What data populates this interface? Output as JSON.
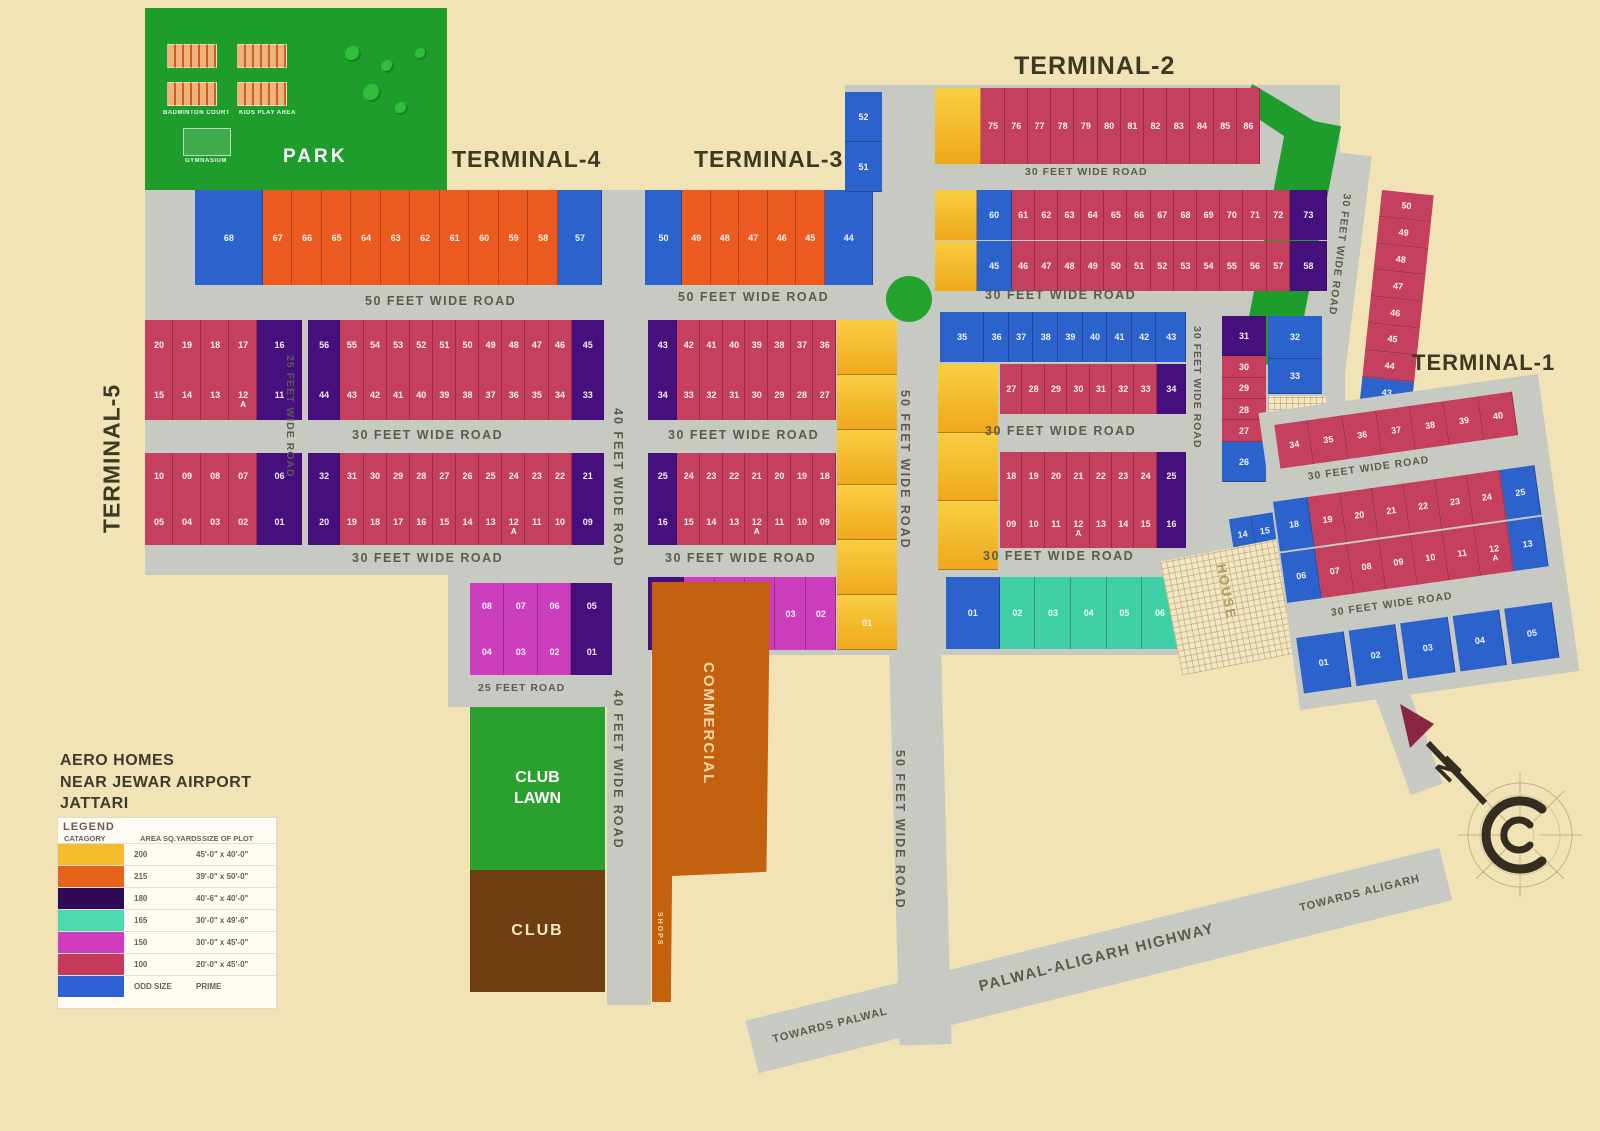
{
  "title": {
    "line1": "AERO HOMES",
    "line2": "NEAR JEWAR AIRPORT",
    "line3": "JATTARI"
  },
  "terminals": {
    "t1": "TERMINAL-1",
    "t2": "TERMINAL-2",
    "t3": "TERMINAL-3",
    "t4": "TERMINAL-4",
    "t5": "TERMINAL-5"
  },
  "park": {
    "label": "PARK",
    "badminton": "BADMINTON COURT",
    "kids": "KIDS PLAY AREA",
    "gym": "GYMNASIUM"
  },
  "amenities": {
    "club_lawn": "CLUB LAWN",
    "club": "CLUB",
    "commercial": "COMMERCIAL",
    "shops": "SHOPS",
    "house": "HOUSE"
  },
  "compass": {
    "n": "N"
  },
  "highway": {
    "name": "PALWAL-ALIGARH HIGHWAY",
    "towards_left": "TOWARDS PALWAL",
    "towards_right": "TOWARDS ALIGARH"
  },
  "roads": {
    "r50a": "50 FEET WIDE ROAD",
    "r50b": "50 FEET WIDE ROAD",
    "r30top": "30 FEET WIDE ROAD",
    "r30t2": "30 FEET WIDE ROAD",
    "r30l1": "30 FEET WIDE ROAD",
    "r30c1": "30 FEET WIDE ROAD",
    "r30r1": "30 FEET WIDE ROAD",
    "r30l2": "30 FEET WIDE ROAD",
    "r30c2": "30 FEET WIDE ROAD",
    "r30r2": "30 FEET WIDE ROAD",
    "r25v": "25 FEET WIDE ROAD",
    "r40v1": "40 FEET WIDE ROAD",
    "r40v2": "40 FEET WIDE ROAD",
    "r50v1": "50 FEET WIDE ROAD",
    "r50v2": "50 FEET WIDE ROAD",
    "r30v1": "30 FEET WIDE ROAD",
    "r30v2": "30 FEET WIDE ROAD",
    "r30fan1": "30 FEET WIDE ROAD",
    "r30fan2": "30 FEET WIDE ROAD",
    "r30diag": "30 FEET WIDE ROAD",
    "r25road": "25 FEET ROAD"
  },
  "legend": {
    "title": "LEGEND",
    "headers": [
      "CATAGORY",
      "AREA SQ.YARDS",
      "SIZE OF PLOT"
    ],
    "rows": [
      {
        "color": "#F7BC2C",
        "area": "200",
        "size": "45'-0\" x 40'-0\""
      },
      {
        "color": "#E7621B",
        "area": "215",
        "size": "39'-0\" x 50'-0\""
      },
      {
        "color": "#2E0A57",
        "area": "180",
        "size": "40'-6\" x 40'-0\""
      },
      {
        "color": "#4DD9B0",
        "area": "165",
        "size": "30'-0\" x 49'-6\""
      },
      {
        "color": "#D23BBE",
        "area": "150",
        "size": "30'-0\" x 45'-0\""
      },
      {
        "color": "#C43A5C",
        "area": "100",
        "size": "20'-0\" x 45'-0\""
      },
      {
        "color": "#2E5FD3",
        "area": "ODD SIZE",
        "size": "PRIME"
      }
    ]
  },
  "blocks": {
    "t4_row": [
      {
        "n": "68",
        "c": "blue",
        "w": 2.3
      },
      {
        "n": "67",
        "c": "orange"
      },
      {
        "n": "66",
        "c": "orange"
      },
      {
        "n": "65",
        "c": "orange"
      },
      {
        "n": "64",
        "c": "orange"
      },
      {
        "n": "63",
        "c": "orange"
      },
      {
        "n": "62",
        "c": "orange"
      },
      {
        "n": "61",
        "c": "orange"
      },
      {
        "n": "60",
        "c": "orange"
      },
      {
        "n": "59",
        "c": "orange"
      },
      {
        "n": "58",
        "c": "orange"
      },
      {
        "n": "57",
        "c": "blue",
        "w": 1.5
      }
    ],
    "t3_row": [
      {
        "n": "50",
        "c": "blue",
        "w": 1.3
      },
      {
        "n": "49",
        "c": "orange"
      },
      {
        "n": "48",
        "c": "orange"
      },
      {
        "n": "47",
        "c": "orange"
      },
      {
        "n": "46",
        "c": "orange"
      },
      {
        "n": "45",
        "c": "orange"
      },
      {
        "n": "44",
        "c": "blue",
        "w": 1.7
      }
    ],
    "t3_side": [
      {
        "n": "52",
        "c": "blue"
      },
      {
        "n": "51",
        "c": "blue"
      }
    ],
    "t2_top": [
      {
        "n": "",
        "c": "yellow",
        "w": 2
      },
      {
        "n": "75"
      },
      {
        "n": "76"
      },
      {
        "n": "77"
      },
      {
        "n": "78"
      },
      {
        "n": "79"
      },
      {
        "n": "80"
      },
      {
        "n": "81"
      },
      {
        "n": "82"
      },
      {
        "n": "83"
      },
      {
        "n": "84"
      },
      {
        "n": "85"
      },
      {
        "n": "86"
      }
    ],
    "t2_r1": [
      {
        "n": "",
        "c": "yellow",
        "w": 1.8
      },
      {
        "n": "60",
        "c": "blue",
        "w": 1.5
      },
      {
        "n": "61"
      },
      {
        "n": "62"
      },
      {
        "n": "63"
      },
      {
        "n": "64"
      },
      {
        "n": "65"
      },
      {
        "n": "66"
      },
      {
        "n": "67"
      },
      {
        "n": "68"
      },
      {
        "n": "69"
      },
      {
        "n": "70"
      },
      {
        "n": "71"
      },
      {
        "n": "72"
      },
      {
        "n": "73",
        "c": "purple",
        "w": 1.6
      }
    ],
    "t2_r2": [
      {
        "n": "",
        "c": "yellow",
        "w": 1.8
      },
      {
        "n": "45",
        "c": "blue",
        "w": 1.5
      },
      {
        "n": "46"
      },
      {
        "n": "47"
      },
      {
        "n": "48"
      },
      {
        "n": "49"
      },
      {
        "n": "50"
      },
      {
        "n": "51"
      },
      {
        "n": "52"
      },
      {
        "n": "53"
      },
      {
        "n": "54"
      },
      {
        "n": "55"
      },
      {
        "n": "56"
      },
      {
        "n": "57"
      },
      {
        "n": "58",
        "c": "purple",
        "w": 1.6
      }
    ],
    "t5_a1": [
      {
        "n": "20"
      },
      {
        "n": "19"
      },
      {
        "n": "18"
      },
      {
        "n": "17"
      },
      {
        "n": "16",
        "c": "purple",
        "w": 1.6
      }
    ],
    "t5_a2": [
      {
        "n": "15"
      },
      {
        "n": "14"
      },
      {
        "n": "13"
      },
      {
        "n": "12",
        "a": "A"
      },
      {
        "n": "11",
        "c": "purple",
        "w": 1.6
      }
    ],
    "t5_b1": [
      {
        "n": "10"
      },
      {
        "n": "09"
      },
      {
        "n": "08"
      },
      {
        "n": "07"
      },
      {
        "n": "06",
        "c": "purple",
        "w": 1.6
      }
    ],
    "t5_b2": [
      {
        "n": "05"
      },
      {
        "n": "04"
      },
      {
        "n": "03"
      },
      {
        "n": "02"
      },
      {
        "n": "01",
        "c": "purple",
        "w": 1.6
      }
    ],
    "c4_r1": [
      {
        "n": "56",
        "c": "purple",
        "w": 1.4
      },
      {
        "n": "55"
      },
      {
        "n": "54"
      },
      {
        "n": "53"
      },
      {
        "n": "52"
      },
      {
        "n": "51"
      },
      {
        "n": "50"
      },
      {
        "n": "49"
      },
      {
        "n": "48"
      },
      {
        "n": "47"
      },
      {
        "n": "46"
      },
      {
        "n": "45",
        "c": "purple",
        "w": 1.4
      }
    ],
    "c4_r2": [
      {
        "n": "44",
        "c": "purple",
        "w": 1.4
      },
      {
        "n": "43"
      },
      {
        "n": "42"
      },
      {
        "n": "41"
      },
      {
        "n": "40"
      },
      {
        "n": "39"
      },
      {
        "n": "38"
      },
      {
        "n": "37"
      },
      {
        "n": "36"
      },
      {
        "n": "35"
      },
      {
        "n": "34"
      },
      {
        "n": "33",
        "c": "purple",
        "w": 1.4
      }
    ],
    "c5_r1": [
      {
        "n": "32",
        "c": "purple",
        "w": 1.4
      },
      {
        "n": "31"
      },
      {
        "n": "30"
      },
      {
        "n": "29"
      },
      {
        "n": "28"
      },
      {
        "n": "27"
      },
      {
        "n": "26"
      },
      {
        "n": "25"
      },
      {
        "n": "24"
      },
      {
        "n": "23"
      },
      {
        "n": "22"
      },
      {
        "n": "21",
        "c": "purple",
        "w": 1.4
      }
    ],
    "c5_r2": [
      {
        "n": "20",
        "c": "purple",
        "w": 1.4
      },
      {
        "n": "19"
      },
      {
        "n": "18"
      },
      {
        "n": "17"
      },
      {
        "n": "16"
      },
      {
        "n": "15"
      },
      {
        "n": "14"
      },
      {
        "n": "13"
      },
      {
        "n": "12",
        "a": "A"
      },
      {
        "n": "11"
      },
      {
        "n": "10"
      },
      {
        "n": "09",
        "c": "purple",
        "w": 1.4
      }
    ],
    "c3_r1": [
      {
        "n": "43",
        "c": "purple",
        "w": 1.3
      },
      {
        "n": "42"
      },
      {
        "n": "41"
      },
      {
        "n": "40"
      },
      {
        "n": "39"
      },
      {
        "n": "38"
      },
      {
        "n": "37"
      },
      {
        "n": "36"
      }
    ],
    "c3_r2": [
      {
        "n": "34",
        "c": "purple",
        "w": 1.3
      },
      {
        "n": "33"
      },
      {
        "n": "32"
      },
      {
        "n": "31"
      },
      {
        "n": "30"
      },
      {
        "n": "29"
      },
      {
        "n": "28"
      },
      {
        "n": "27"
      }
    ],
    "c3_r3": [
      {
        "n": "25",
        "c": "purple",
        "w": 1.3
      },
      {
        "n": "24"
      },
      {
        "n": "23"
      },
      {
        "n": "22"
      },
      {
        "n": "21"
      },
      {
        "n": "20"
      },
      {
        "n": "19"
      },
      {
        "n": "18"
      }
    ],
    "c3_r4": [
      {
        "n": "16",
        "c": "purple",
        "w": 1.3
      },
      {
        "n": "15"
      },
      {
        "n": "14"
      },
      {
        "n": "13"
      },
      {
        "n": "12",
        "a": "A"
      },
      {
        "n": "11"
      },
      {
        "n": "10"
      },
      {
        "n": "09"
      }
    ],
    "c3_r5": [
      {
        "n": "07",
        "c": "purple",
        "w": 1.2
      },
      {
        "n": "06",
        "c": "magenta"
      },
      {
        "n": "05",
        "c": "magenta"
      },
      {
        "n": "04",
        "c": "magenta"
      },
      {
        "n": "03",
        "c": "magenta"
      },
      {
        "n": "02",
        "c": "magenta"
      }
    ],
    "yellow_col_a": [
      {
        "n": "",
        "c": "yellow"
      },
      {
        "n": "",
        "c": "yellow"
      },
      {
        "n": "",
        "c": "yellow"
      },
      {
        "n": "",
        "c": "yellow"
      },
      {
        "n": "",
        "c": "yellow"
      },
      {
        "n": "01",
        "c": "yellow"
      }
    ],
    "yellow_col_b": [
      {
        "n": "",
        "c": "yellow"
      },
      {
        "n": "",
        "c": "yellow"
      },
      {
        "n": "",
        "c": "yellow"
      }
    ],
    "m_r1": [
      {
        "n": "08",
        "c": "magenta"
      },
      {
        "n": "07",
        "c": "magenta"
      },
      {
        "n": "06",
        "c": "magenta"
      },
      {
        "n": "05",
        "c": "purple",
        "w": 1.2
      }
    ],
    "m_r2": [
      {
        "n": "04",
        "c": "magenta"
      },
      {
        "n": "03",
        "c": "magenta"
      },
      {
        "n": "02",
        "c": "magenta"
      },
      {
        "n": "01",
        "c": "purple",
        "w": 1.2
      }
    ],
    "blue_row": [
      {
        "n": "35",
        "c": "blue",
        "w": 1.8
      },
      {
        "n": "36",
        "c": "blue"
      },
      {
        "n": "37",
        "c": "blue"
      },
      {
        "n": "38",
        "c": "blue"
      },
      {
        "n": "39",
        "c": "blue"
      },
      {
        "n": "40",
        "c": "blue"
      },
      {
        "n": "41",
        "c": "blue"
      },
      {
        "n": "42",
        "c": "blue"
      },
      {
        "n": "43",
        "c": "blue",
        "w": 1.2
      }
    ],
    "r2_r2": [
      {
        "n": "27"
      },
      {
        "n": "28"
      },
      {
        "n": "29"
      },
      {
        "n": "30"
      },
      {
        "n": "31"
      },
      {
        "n": "32"
      },
      {
        "n": "33"
      },
      {
        "n": "34",
        "c": "purple",
        "w": 1.3
      }
    ],
    "r2_r3": [
      {
        "n": "18"
      },
      {
        "n": "19"
      },
      {
        "n": "20"
      },
      {
        "n": "21"
      },
      {
        "n": "22"
      },
      {
        "n": "23"
      },
      {
        "n": "24"
      },
      {
        "n": "25",
        "c": "purple",
        "w": 1.3
      }
    ],
    "r2_r4": [
      {
        "n": "09"
      },
      {
        "n": "10"
      },
      {
        "n": "11"
      },
      {
        "n": "12",
        "a": "A"
      },
      {
        "n": "13"
      },
      {
        "n": "14"
      },
      {
        "n": "15"
      },
      {
        "n": "16",
        "c": "purple",
        "w": 1.3
      }
    ],
    "teal_row": [
      {
        "n": "01",
        "c": "blue",
        "w": 1.5
      },
      {
        "n": "02",
        "c": "teal"
      },
      {
        "n": "03",
        "c": "teal"
      },
      {
        "n": "04",
        "c": "teal"
      },
      {
        "n": "05",
        "c": "teal"
      },
      {
        "n": "06",
        "c": "teal"
      },
      {
        "n": "07",
        "c": "blue",
        "w": 0.9
      }
    ],
    "rc_col1": [
      {
        "n": "31",
        "c": "purple",
        "w": 1.9
      },
      {
        "n": "30"
      },
      {
        "n": "29"
      },
      {
        "n": "28"
      },
      {
        "n": "27"
      },
      {
        "n": "26",
        "c": "blue",
        "w": 1.9
      }
    ],
    "rc_col2": [
      {
        "n": "32",
        "c": "blue",
        "w": 1.2
      },
      {
        "n": "33",
        "c": "blue"
      }
    ],
    "row1417": [
      {
        "n": "14",
        "c": "blue"
      },
      {
        "n": "15",
        "c": "blue"
      },
      {
        "n": "16",
        "c": "blue"
      },
      {
        "n": "17",
        "c": "blue"
      }
    ],
    "t1_strip": [
      {
        "n": "50"
      },
      {
        "n": "49"
      },
      {
        "n": "48"
      },
      {
        "n": "47"
      },
      {
        "n": "46"
      },
      {
        "n": "45"
      },
      {
        "n": "44"
      },
      {
        "n": "43",
        "c": "blue"
      },
      {
        "n": "42",
        "c": "blue"
      },
      {
        "n": "41",
        "c": "blue"
      }
    ],
    "fan_a": [
      {
        "n": "34"
      },
      {
        "n": "35"
      },
      {
        "n": "36"
      },
      {
        "n": "37"
      },
      {
        "n": "38"
      },
      {
        "n": "39"
      },
      {
        "n": "40"
      }
    ],
    "fan_b": [
      {
        "n": "18",
        "c": "blue",
        "w": 1.1
      },
      {
        "n": "19"
      },
      {
        "n": "20"
      },
      {
        "n": "21"
      },
      {
        "n": "22"
      },
      {
        "n": "23"
      },
      {
        "n": "24"
      },
      {
        "n": "25",
        "c": "blue",
        "w": 1.1
      }
    ],
    "fan_c": [
      {
        "n": "06",
        "c": "blue",
        "w": 1.1
      },
      {
        "n": "07"
      },
      {
        "n": "08"
      },
      {
        "n": "09"
      },
      {
        "n": "10"
      },
      {
        "n": "11"
      },
      {
        "n": "12",
        "a": "A"
      },
      {
        "n": "13",
        "c": "blue",
        "w": 1.1
      }
    ],
    "fan_d": [
      {
        "n": "01",
        "c": "blue"
      },
      {
        "n": "02",
        "c": "blue"
      },
      {
        "n": "03",
        "c": "blue"
      },
      {
        "n": "04",
        "c": "blue"
      },
      {
        "n": "05",
        "c": "blue"
      }
    ]
  }
}
